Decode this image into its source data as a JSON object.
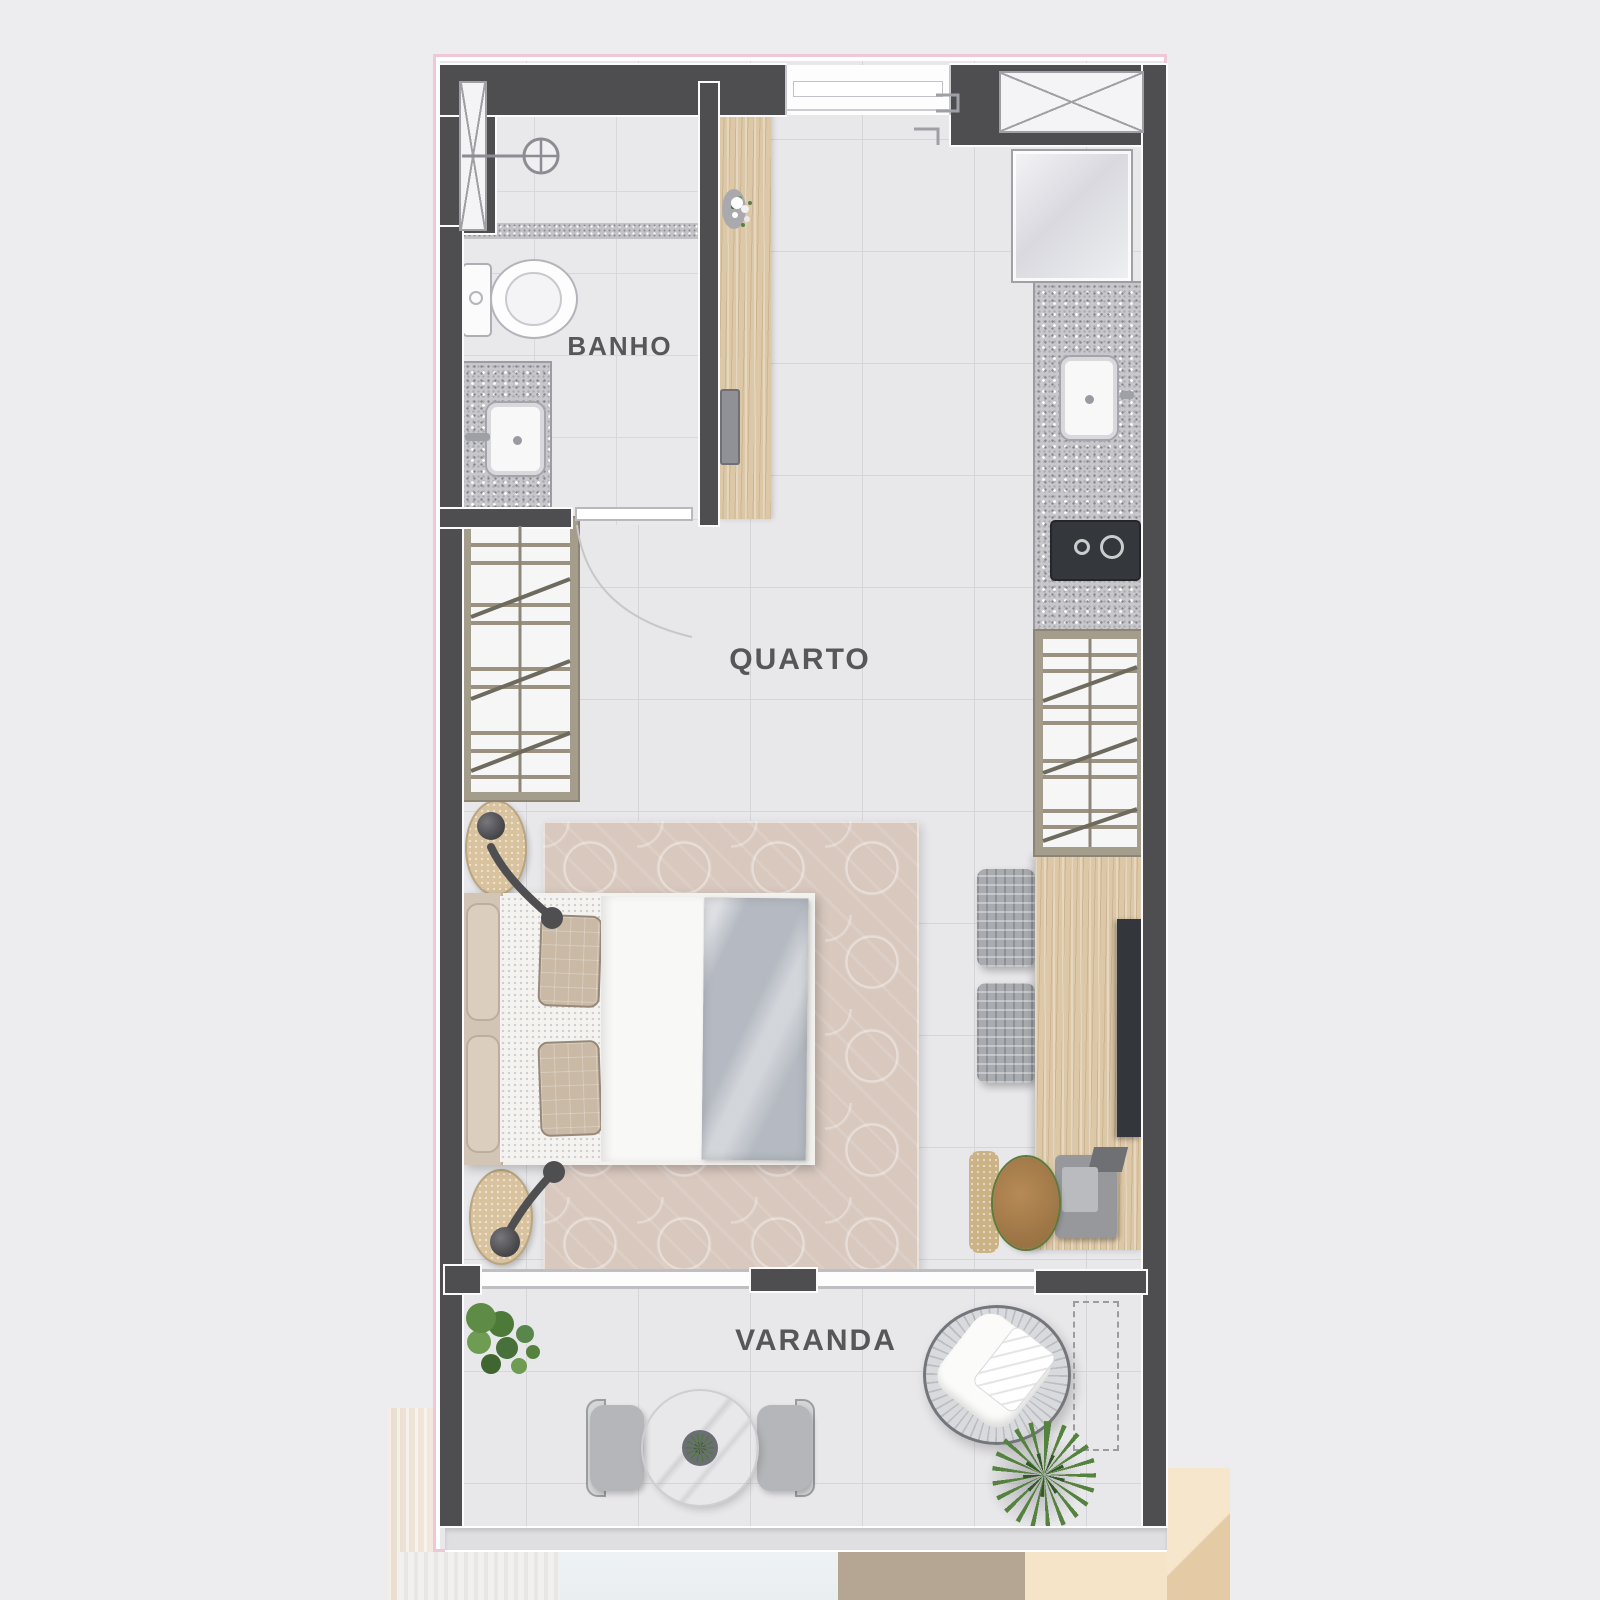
{
  "plan": {
    "type": "apartment-floor-plan",
    "rooms": [
      {
        "id": "banho",
        "label": "BANHO"
      },
      {
        "id": "quarto",
        "label": "QUARTO"
      },
      {
        "id": "varanda",
        "label": "VARANDA"
      }
    ]
  },
  "colors": {
    "page_background": "#ededef",
    "plan_border_pink": "#efc7d9",
    "wall": "#4e4e51",
    "floor_tile": "#e8e8eb",
    "floor_grid_line": "#d6d6da",
    "wood": "#dcc7a6",
    "granite_counter": "#c8c8cc",
    "rug": "#d8c8be",
    "blanket": "#b5bac2",
    "label_text": "#57575a",
    "plant_green": "#5e8b45"
  }
}
